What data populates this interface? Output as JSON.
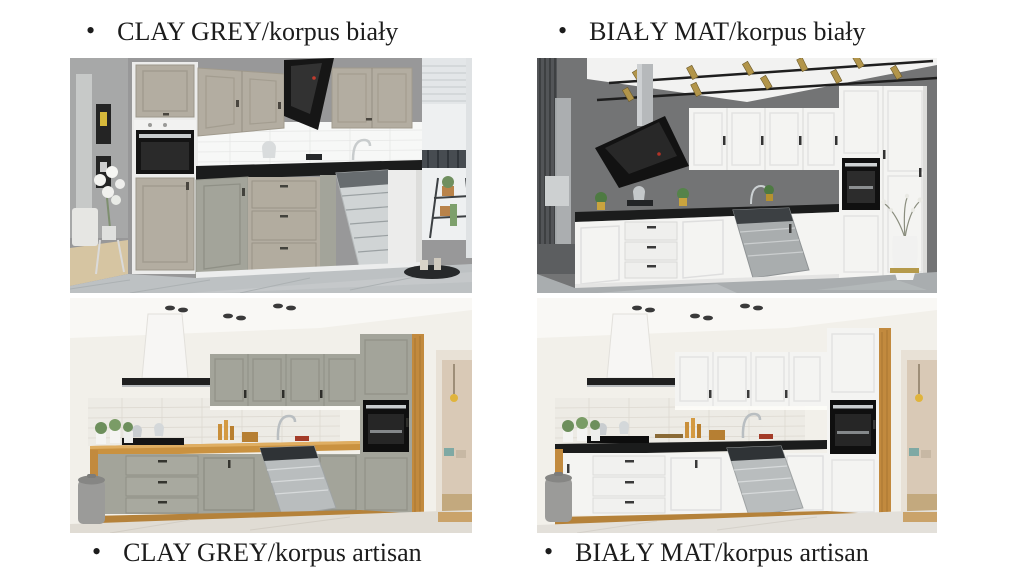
{
  "bullet": "•",
  "captions": {
    "top_left": "CLAY GREY/korpus biały",
    "top_right": "BIAŁY MAT/korpus biały",
    "bottom_left": "CLAY GREY/korpus artisan",
    "bottom_right": "BIAŁY MAT/korpus artisan"
  },
  "images": {
    "top_left": {
      "alt": "Clay grey L-shaped kitchen with white carcass, grey walls, white tile backsplash, black worktop, black angled hood, open dishwasher and balcony window"
    },
    "top_right": {
      "alt": "White matt kitchen with white carcass, dark grey walls, white ceiling panel with gold track spotlights, black worktop, black angled hood and open dishwasher"
    },
    "bottom_left": {
      "alt": "Clay grey kitchen with artisan oak carcass, oak worktop, white tiled backsplash, white chimney hood, black built-in oven and open dishwasher in a bright room"
    },
    "bottom_right": {
      "alt": "White matt kitchen with artisan oak carcass, black worktop, white tiled backsplash, white chimney hood, black built-in oven and open dishwasher in a bright room"
    }
  },
  "colors": {
    "background": "#ffffff",
    "caption_text": "#1c1c1c",
    "clay_grey": "#b3ada1",
    "clay_grey_dark": "#a3a49a",
    "bialy_mat": "#f4f4f2",
    "korpus_bialy": "#ececeb",
    "korpus_artisan": "#c28a3e",
    "worktop_black": "#1b1c1c",
    "worktop_oak": "#ca9240",
    "wall_grey": "#989899",
    "wall_dark_grey": "#737475",
    "wall_cream": "#f2f0ea"
  }
}
